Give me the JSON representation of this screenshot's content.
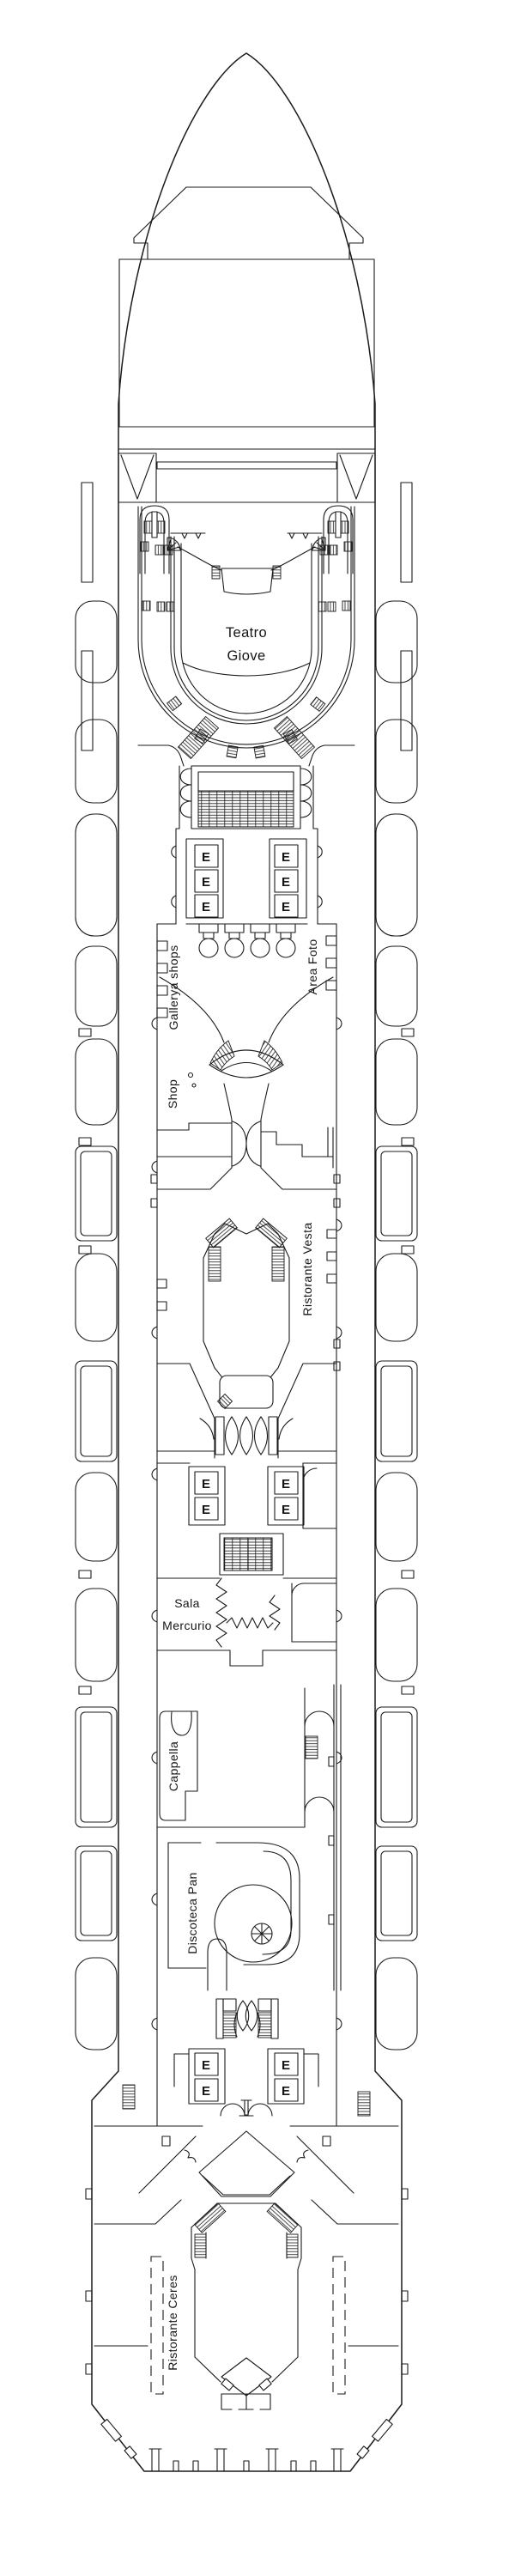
{
  "diagram": {
    "type": "cruise-ship-deck-plan",
    "colors": {
      "line": "#1b1b1b",
      "background": "#ffffff"
    },
    "labels": {
      "theatre_line1": "Teatro",
      "theatre_line2": "Giove",
      "galleria": "Gallerya shops",
      "area_foto": "Area Foto",
      "shop": "Shop",
      "ristorante_vesta": "Ristorante Vesta",
      "sala_line1": "Sala",
      "sala_line2": "Mercurio",
      "cappella": "Cappella",
      "discoteca": "Discoteca Pan",
      "ristorante_ceres": "Ristorante Ceres",
      "elevator": "E"
    },
    "icons": {
      "elevator_box": "elevator-icon",
      "spiral_stair": "spiral-staircase-icon",
      "stairs": "staircase-hatch-icon",
      "lifeboat": "lifeboat-icon"
    }
  }
}
